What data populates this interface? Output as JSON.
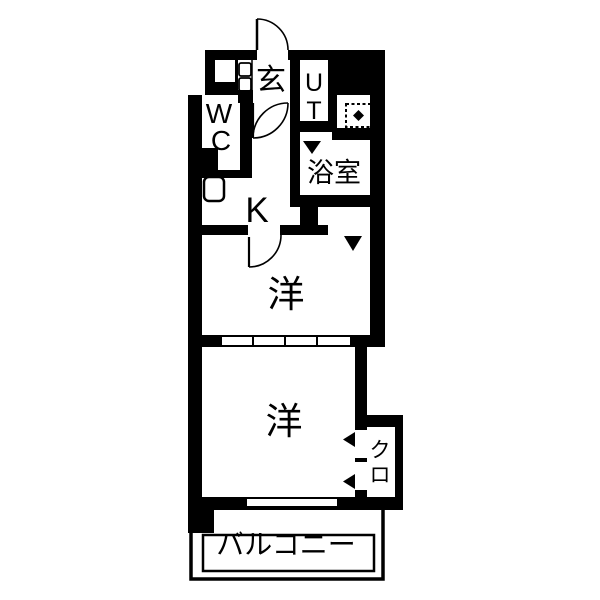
{
  "floorplan": {
    "type": "japanese-apartment-madori",
    "colors": {
      "wall": "#000000",
      "background": "#ffffff",
      "line": "#000000"
    },
    "rooms": {
      "entrance": {
        "label": "玄"
      },
      "utility": {
        "label": "UT",
        "lines": [
          "U",
          "T"
        ]
      },
      "wc": {
        "label": "WC",
        "lines": [
          "W",
          "C"
        ]
      },
      "bathroom": {
        "label": "浴室"
      },
      "kitchen": {
        "label": "K"
      },
      "western_room_1": {
        "label": "洋"
      },
      "western_room_2": {
        "label": "洋"
      },
      "closet": {
        "label": "クロ",
        "lines": [
          "ク",
          "ロ"
        ]
      },
      "balcony": {
        "label": "バルコニー"
      }
    },
    "icons": {
      "washing_machine_area": "dashed-square-with-diamond",
      "kitchen_sink": "rounded-square",
      "shoe_cabinet": "stacked-small-rects",
      "door_swing": "quarter-circle-arc",
      "door_marker": "triangle"
    }
  }
}
